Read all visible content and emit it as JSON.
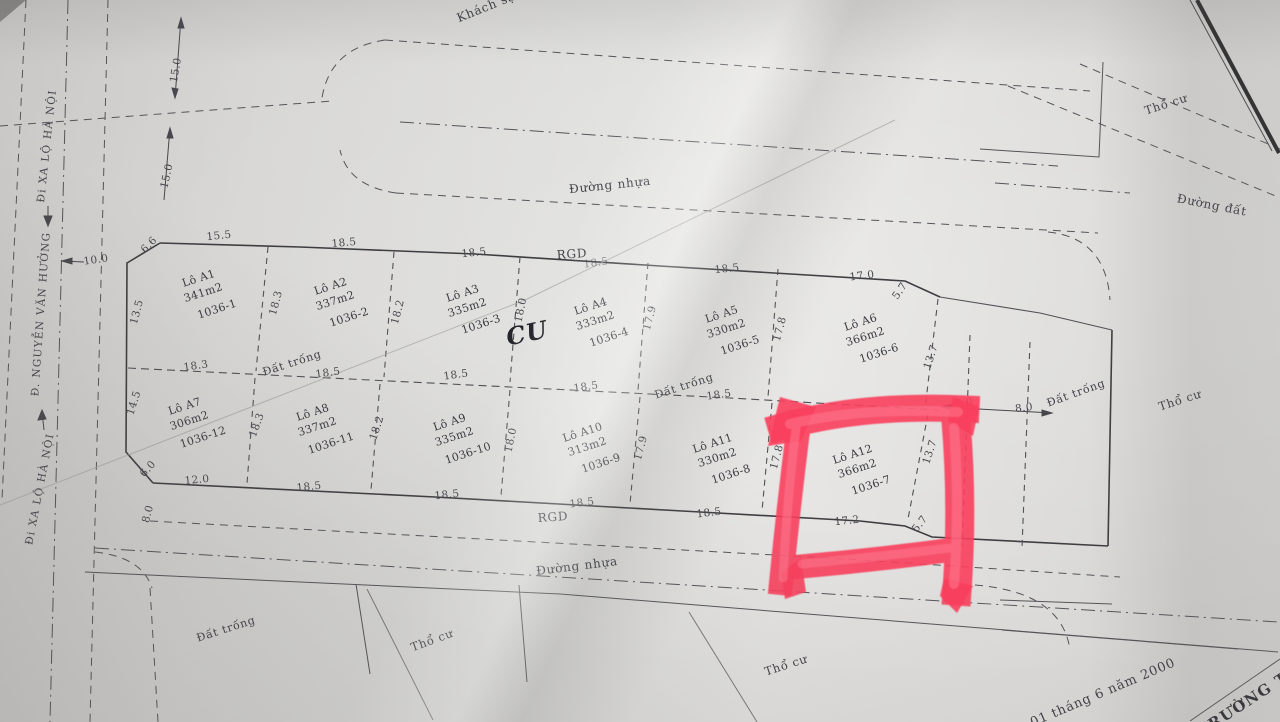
{
  "map": {
    "highlight": {
      "target_plot": "Lô A12",
      "target_parcel": "1036-7",
      "marker_color": "#fa3f5d"
    },
    "streets": [
      {
        "text": "Đi XA LỘ HÀ NỘI"
      },
      {
        "text": "Đ. NGUYỄN VĂN HƯỞNG"
      },
      {
        "text": "Đi XA LỘ HÀ NỘI"
      }
    ],
    "plots": [
      {
        "name": "Lô A1",
        "area": "341m2",
        "parcel": "1036-1",
        "x": 204,
        "y": 295,
        "r": -18
      },
      {
        "name": "Lô A2",
        "area": "337m2",
        "parcel": "1036-2",
        "x": 336,
        "y": 303,
        "r": -18
      },
      {
        "name": "Lô A3",
        "area": "335m2",
        "parcel": "1036-3",
        "x": 468,
        "y": 310,
        "r": -18
      },
      {
        "name": "Lô A4",
        "area": "333m2",
        "parcel": "1036-4",
        "x": 596,
        "y": 323,
        "r": -18
      },
      {
        "name": "Lô A5",
        "area": "330m2",
        "parcel": "1036-5",
        "x": 727,
        "y": 331,
        "r": -18
      },
      {
        "name": "Lô A6",
        "area": "366m2",
        "parcel": "1036-6",
        "x": 866,
        "y": 339,
        "r": -18
      },
      {
        "name": "Lô A7",
        "area": "306m2",
        "parcel": "1036-12",
        "x": 190,
        "y": 423,
        "r": -18
      },
      {
        "name": "Lô A8",
        "area": "337m2",
        "parcel": "1036-11",
        "x": 318,
        "y": 429,
        "r": -18
      },
      {
        "name": "Lô A9",
        "area": "335m2",
        "parcel": "1036-10",
        "x": 455,
        "y": 439,
        "r": -18
      },
      {
        "name": "Lô A10",
        "area": "313m2",
        "parcel": "1036-9",
        "x": 588,
        "y": 449,
        "r": -18
      },
      {
        "name": "Lô A11",
        "area": "330m2",
        "parcel": "1036-8",
        "x": 718,
        "y": 460,
        "r": -18
      },
      {
        "name": "Lô A12",
        "area": "366m2",
        "parcel": "1036-7",
        "x": 858,
        "y": 471,
        "r": -18
      }
    ],
    "labels": [
      {
        "t": "Khách sạ",
        "x": 486,
        "y": 7,
        "r": -22,
        "s": 12,
        "c": "road",
        "n": "label-khach-san"
      },
      {
        "t": "Đường nhựa",
        "x": 610,
        "y": 185,
        "r": -6,
        "s": 12,
        "c": "road",
        "n": "label-duong-nhua-top"
      },
      {
        "t": "Đường đất",
        "x": 1212,
        "y": 205,
        "r": 11,
        "s": 12,
        "c": "road",
        "n": "label-duong-dat"
      },
      {
        "t": "Thổ cư",
        "x": 1166,
        "y": 104,
        "r": -18,
        "s": 11.5,
        "c": "road",
        "n": "label-tho-cu-topright"
      },
      {
        "t": "RGD",
        "x": 572,
        "y": 254,
        "r": -4,
        "s": 12,
        "c": "road",
        "n": "label-rgd-top"
      },
      {
        "t": "Đất trống",
        "x": 292,
        "y": 363,
        "r": -18,
        "s": 11,
        "c": "road",
        "n": "label-dat-trong-row1"
      },
      {
        "t": "Đất trống",
        "x": 684,
        "y": 386,
        "r": -18,
        "s": 11,
        "c": "road",
        "n": "label-dat-trong-mid"
      },
      {
        "t": "Đất trống",
        "x": 1076,
        "y": 393,
        "r": -20,
        "s": 11,
        "c": "road",
        "n": "label-dat-trong-right"
      },
      {
        "t": "Thổ cư",
        "x": 1180,
        "y": 400,
        "r": -18,
        "s": 11.5,
        "c": "road",
        "n": "label-tho-cu-right"
      },
      {
        "t": "RGD",
        "x": 553,
        "y": 517,
        "r": -4,
        "s": 12,
        "c": "road",
        "n": "label-rgd-bottom"
      },
      {
        "t": "Đường nhựa",
        "x": 577,
        "y": 566,
        "r": -7,
        "s": 12,
        "c": "road",
        "n": "label-duong-nhua-bottom"
      },
      {
        "t": "Đất trống",
        "x": 226,
        "y": 629,
        "r": -18,
        "s": 11,
        "c": "road",
        "n": "label-dat-trong-bottomleft"
      },
      {
        "t": "Thổ cư",
        "x": 432,
        "y": 640,
        "r": -20,
        "s": 11.5,
        "c": "road",
        "n": "label-tho-cu-bottomleft"
      },
      {
        "t": "Thổ cư",
        "x": 786,
        "y": 665,
        "r": -18,
        "s": 11.5,
        "c": "road",
        "n": "label-tho-cu-bottommid"
      },
      {
        "t": "CU",
        "x": 527,
        "y": 333,
        "r": -12,
        "s": 24,
        "c": "hand",
        "n": "handwritten-cu-mark"
      },
      {
        "t": "01 tháng 6 năm 2000",
        "x": 1103,
        "y": 693,
        "r": -23,
        "s": 13,
        "c": "road",
        "n": "label-date"
      },
      {
        "t": "TRƯỜNG T",
        "x": 1243,
        "y": 704,
        "r": -33,
        "s": 15,
        "c": "stamp",
        "n": "label-truong-stamp"
      }
    ],
    "measurements": [
      {
        "t": "15.5",
        "x": 219,
        "y": 236,
        "r": -6
      },
      {
        "t": "18.5",
        "x": 344,
        "y": 243,
        "r": -5
      },
      {
        "t": "18.5",
        "x": 474,
        "y": 253,
        "r": -6
      },
      {
        "t": "18.5",
        "x": 596,
        "y": 263,
        "r": -8,
        "c": "faint"
      },
      {
        "t": "18.5",
        "x": 727,
        "y": 269,
        "r": -6
      },
      {
        "t": "17.0",
        "x": 862,
        "y": 276,
        "r": -7
      },
      {
        "t": "5.7",
        "x": 900,
        "y": 291,
        "r": -55
      },
      {
        "t": "10.0",
        "x": 96,
        "y": 260,
        "r": -8
      },
      {
        "t": "6.6",
        "x": 149,
        "y": 245,
        "r": -46
      },
      {
        "t": "13.5",
        "x": 137,
        "y": 312,
        "r": -75
      },
      {
        "t": "15.0",
        "x": 176,
        "y": 70,
        "r": -80
      },
      {
        "t": "15.0",
        "x": 167,
        "y": 176,
        "r": -77
      },
      {
        "t": "18.3",
        "x": 276,
        "y": 303,
        "r": -75
      },
      {
        "t": "18.2",
        "x": 398,
        "y": 312,
        "r": -75
      },
      {
        "t": "18.0",
        "x": 521,
        "y": 310,
        "r": -78
      },
      {
        "t": "17.9",
        "x": 650,
        "y": 318,
        "r": -75
      },
      {
        "t": "17.8",
        "x": 780,
        "y": 329,
        "r": -75
      },
      {
        "t": "13.7",
        "x": 931,
        "y": 357,
        "r": -72
      },
      {
        "t": "18.3",
        "x": 196,
        "y": 366,
        "r": -8
      },
      {
        "t": "18.5",
        "x": 328,
        "y": 373,
        "r": -8
      },
      {
        "t": "18.5",
        "x": 456,
        "y": 375,
        "r": -8
      },
      {
        "t": "18.5",
        "x": 586,
        "y": 387,
        "r": -8
      },
      {
        "t": "18.5",
        "x": 719,
        "y": 395,
        "r": -8
      },
      {
        "t": "14.5",
        "x": 134,
        "y": 403,
        "r": -72
      },
      {
        "t": "18.3",
        "x": 257,
        "y": 425,
        "r": -70
      },
      {
        "t": "18.2",
        "x": 377,
        "y": 428,
        "r": -72
      },
      {
        "t": "18.0",
        "x": 511,
        "y": 440,
        "r": -78
      },
      {
        "t": "17.9",
        "x": 641,
        "y": 448,
        "r": -75
      },
      {
        "t": "17.8",
        "x": 777,
        "y": 457,
        "r": -75
      },
      {
        "t": "13.7",
        "x": 930,
        "y": 452,
        "r": -72
      },
      {
        "t": "6.0",
        "x": 148,
        "y": 469,
        "r": -48
      },
      {
        "t": "12.0",
        "x": 197,
        "y": 480,
        "r": -5
      },
      {
        "t": "18.5",
        "x": 309,
        "y": 487,
        "r": -6
      },
      {
        "t": "18.5",
        "x": 447,
        "y": 495,
        "r": -6
      },
      {
        "t": "18.5",
        "x": 582,
        "y": 503,
        "r": -7
      },
      {
        "t": "18.5",
        "x": 709,
        "y": 513,
        "r": -7
      },
      {
        "t": "17.2",
        "x": 847,
        "y": 521,
        "r": -6
      },
      {
        "t": "5.7",
        "x": 920,
        "y": 524,
        "r": -52
      },
      {
        "t": "8.0",
        "x": 148,
        "y": 514,
        "r": -75
      },
      {
        "t": "8.0",
        "x": 964,
        "y": 403,
        "r": -7
      },
      {
        "t": "8.0",
        "x": 1024,
        "y": 408,
        "r": -7
      }
    ]
  }
}
